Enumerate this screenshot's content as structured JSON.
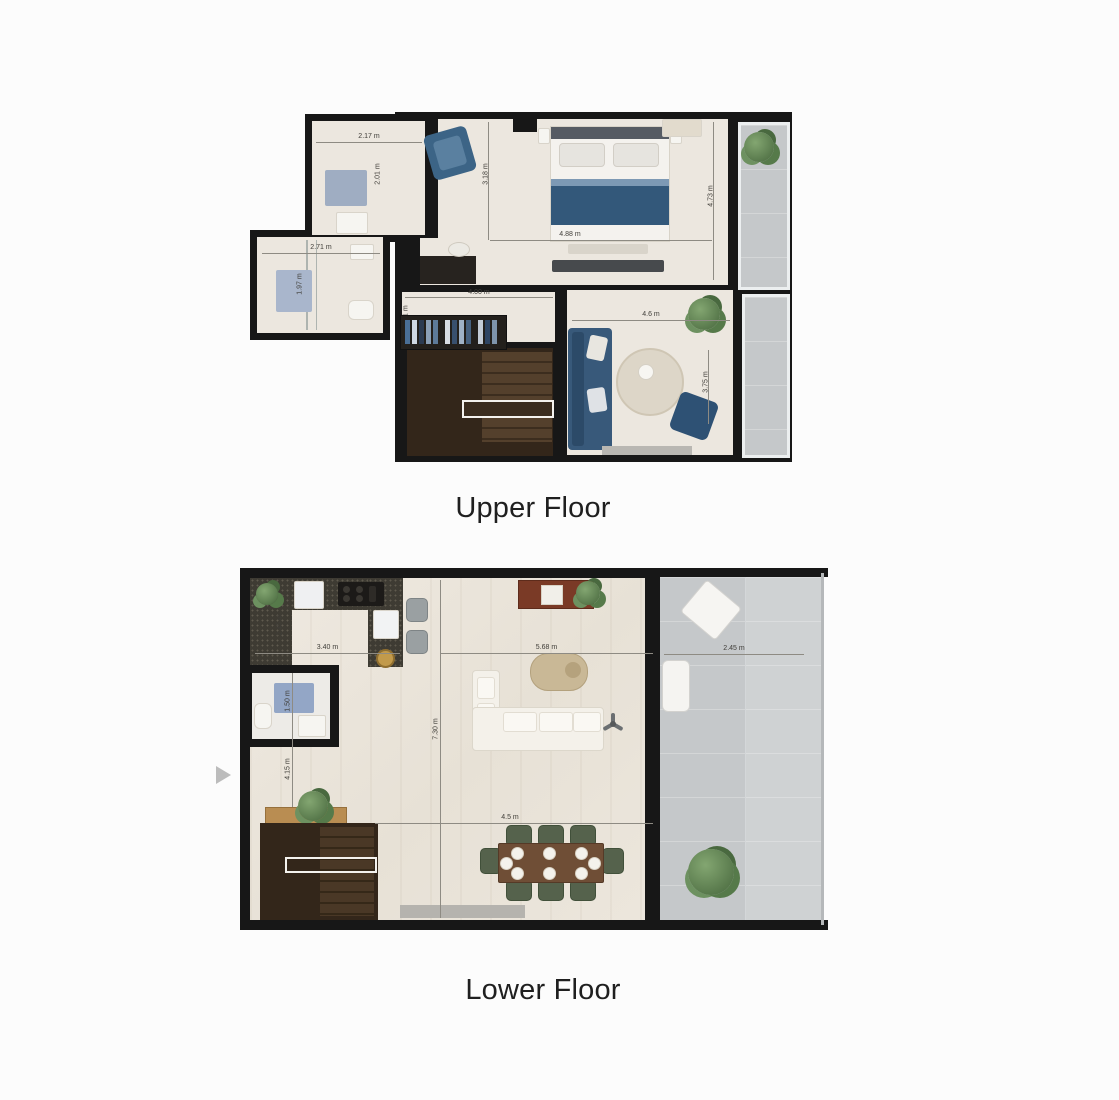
{
  "upper_floor": {
    "title": "Upper Floor",
    "dimensions": {
      "bedroom2_width": "2.17 m",
      "bedroom2_depth": "2.01 m",
      "bathroom_width": "2.71 m",
      "bathroom_depth": "1.97 m",
      "bedroom1_width": "4.88 m",
      "bedroom1_depth": "3.18 m",
      "balcony_side_depth": "4.73 m",
      "hallway_width": "4.00 m",
      "hallway_depth": "1.51 m",
      "tv_room_width": "4.6 m",
      "tv_room_depth": "3.75 m"
    }
  },
  "lower_floor": {
    "title": "Lower Floor",
    "dimensions": {
      "kitchen_width": "3.40 m",
      "kitchen_depth": "2.45 m",
      "bathroom_depth": "1.50 m",
      "hallway_depth": "4.15 m",
      "living_width": "5.68 m",
      "living_depth": "7.30 m",
      "dining_width": "4.5 m",
      "terrace_width": "2.45 m"
    }
  },
  "carousel": {
    "arrow_direction": "right"
  },
  "colors": {
    "wall": "#171717",
    "floor": "#ece7df",
    "terrace": "#c5c8ca",
    "accent_blue": "#38597a",
    "stair_wood": "#33261a",
    "dining_chair_green": "#55624c",
    "title_text": "#1f1f1f"
  }
}
